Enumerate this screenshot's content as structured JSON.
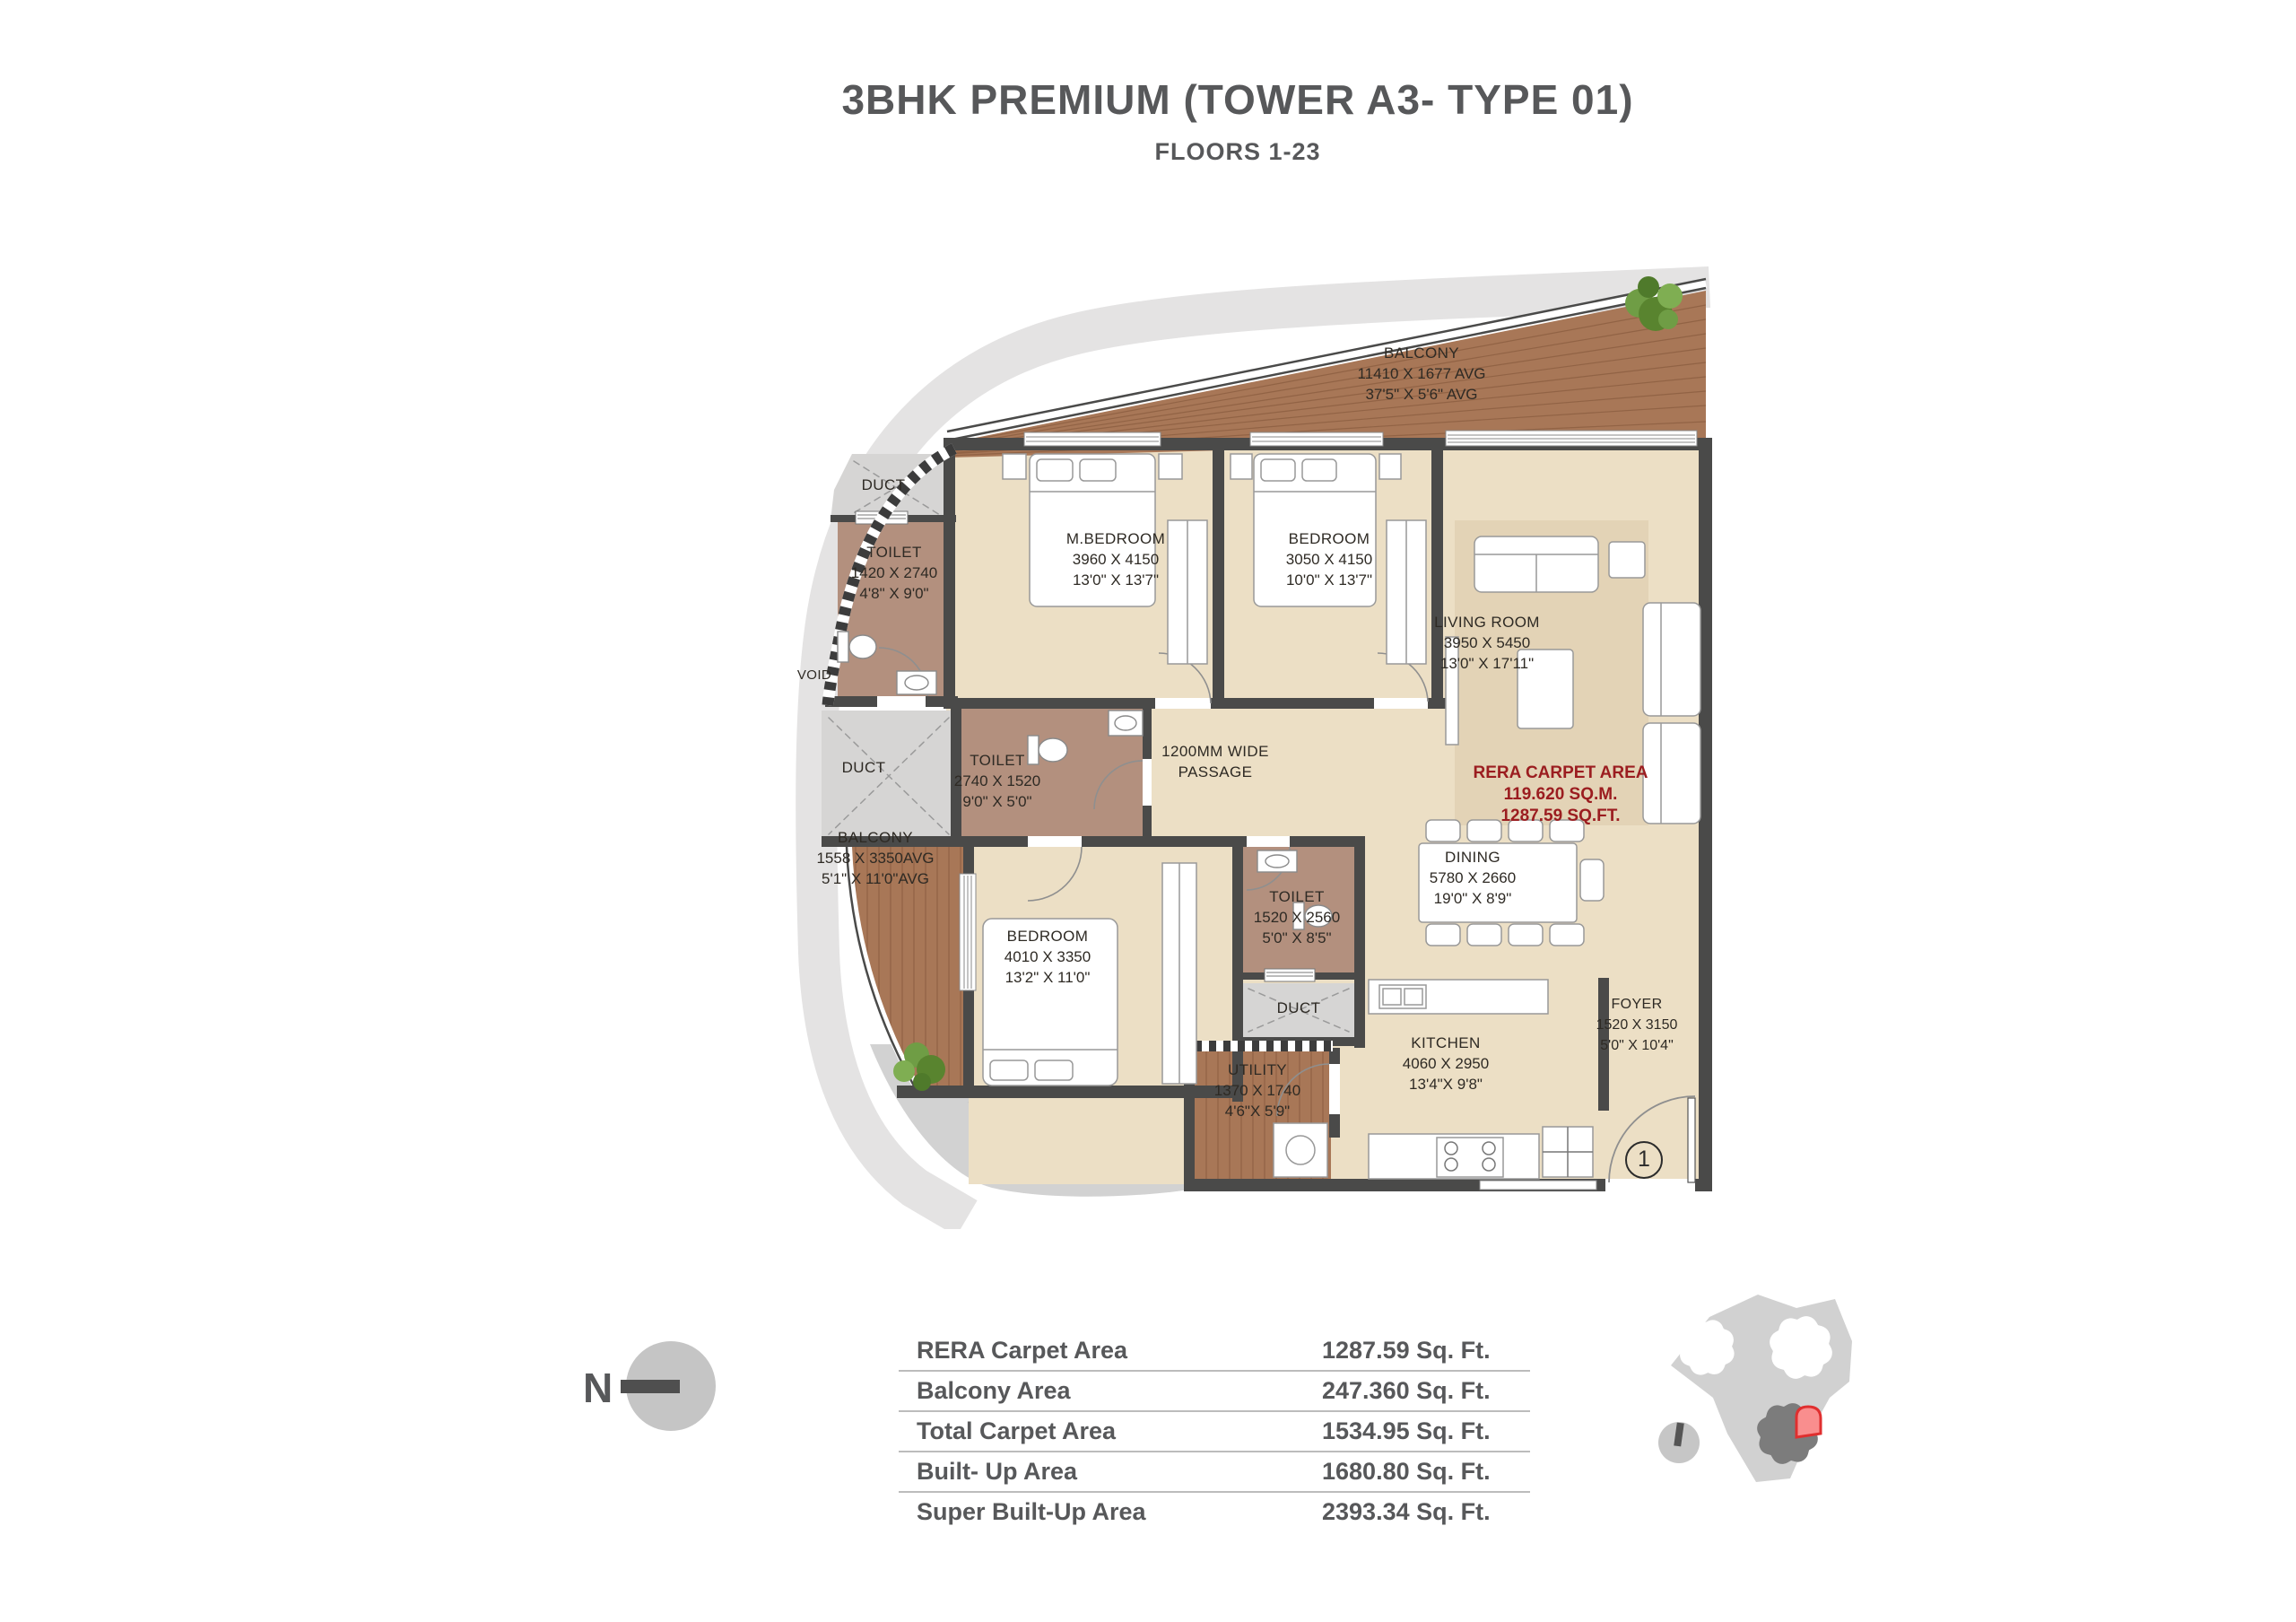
{
  "header": {
    "title": "3BHK PREMIUM (TOWER A3- TYPE 01)",
    "subtitle": "FLOORS 1-23"
  },
  "plan": {
    "rooms": [
      {
        "id": "balcony-top",
        "label": "BALCONY",
        "dim_mm": "11410 X 1677 AVG",
        "dim_ft": "37'5\" X 5'6\" AVG"
      },
      {
        "id": "duct-top",
        "label": "DUCT"
      },
      {
        "id": "toilet-top",
        "label": "TOILET",
        "dim_mm": "1420 X 2740",
        "dim_ft": "4'8\" X 9'0\""
      },
      {
        "id": "m-bedroom",
        "label": "M.BEDROOM",
        "dim_mm": "3960 X 4150",
        "dim_ft": "13'0\" X 13'7\""
      },
      {
        "id": "bedroom-2",
        "label": "BEDROOM",
        "dim_mm": "3050 X 4150",
        "dim_ft": "10'0\" X 13'7\""
      },
      {
        "id": "living-room",
        "label": "LIVING ROOM",
        "dim_mm": "3950 X 5450",
        "dim_ft": "13'0\" X 17'11\""
      },
      {
        "id": "void",
        "label": "VOID"
      },
      {
        "id": "duct-mid",
        "label": "DUCT"
      },
      {
        "id": "toilet-mid",
        "label": "TOILET",
        "dim_mm": "2740 X 1520",
        "dim_ft": "9'0\" X 5'0\""
      },
      {
        "id": "passage",
        "label": "1200MM WIDE",
        "label2": "PASSAGE"
      },
      {
        "id": "balcony-left",
        "label": "BALCONY",
        "dim_mm": "1558 X 3350AVG",
        "dim_ft": "5'1\" X 11'0\"AVG"
      },
      {
        "id": "dining",
        "label": "DINING",
        "dim_mm": "5780 X 2660",
        "dim_ft": "19'0\" X 8'9\""
      },
      {
        "id": "toilet-bottom",
        "label": "TOILET",
        "dim_mm": "1520 X 2560",
        "dim_ft": "5'0\" X 8'5\""
      },
      {
        "id": "bedroom-3",
        "label": "BEDROOM",
        "dim_mm": "4010 X 3350",
        "dim_ft": "13'2\" X 11'0\""
      },
      {
        "id": "duct-bottom",
        "label": "DUCT"
      },
      {
        "id": "utility",
        "label": "UTILITY",
        "dim_mm": "1370 X 1740",
        "dim_ft": "4'6\"X 5'9\""
      },
      {
        "id": "kitchen",
        "label": "KITCHEN",
        "dim_mm": "4060 X 2950",
        "dim_ft": "13'4\"X 9'8\""
      },
      {
        "id": "foyer",
        "label": "FOYER",
        "dim_mm": "1520 X 3150",
        "dim_ft": "5'0\" X 10'4\""
      }
    ],
    "rera_note": {
      "line1": "RERA CARPET AREA",
      "line2": "119.620 SQ.M.",
      "line3": "1287.59 SQ.FT."
    },
    "entry_marker": "1"
  },
  "areas_table": {
    "rows": [
      {
        "label": "RERA Carpet Area",
        "value": "1287.59 Sq. Ft."
      },
      {
        "label": "Balcony Area",
        "value": "247.360 Sq. Ft."
      },
      {
        "label": "Total Carpet Area",
        "value": "1534.95 Sq. Ft."
      },
      {
        "label": "Built- Up Area",
        "value": "1680.80 Sq. Ft."
      },
      {
        "label": "Super Built-Up Area",
        "value": "2393.34 Sq. Ft."
      }
    ]
  },
  "north": {
    "label": "N"
  },
  "colors": {
    "accent_red": "#9b1d20",
    "wall": "#4a4a49",
    "wood_deck": "#a87757",
    "floor_beige": "#ecdfc5",
    "toilet_floor": "#b3907e",
    "outer_band": "#e4e3e3",
    "highlight_unit": "#f98e8e",
    "highlight_outline": "#e02f2f"
  }
}
